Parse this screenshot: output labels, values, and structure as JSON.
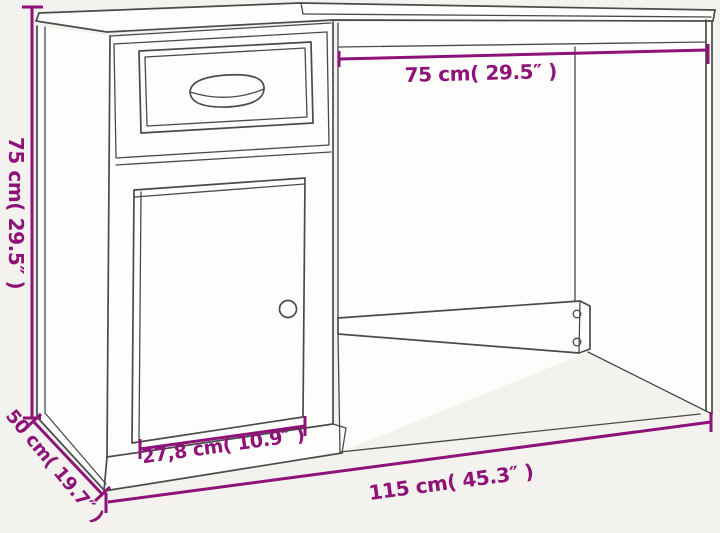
{
  "page": {
    "background_color": "#f3f2ef"
  },
  "drawing": {
    "subject": "desk with drawer and cabinet, technical line drawing",
    "line_color": "#4a4a4a",
    "face_color": "#fdfdfc",
    "parts": [
      "desktop",
      "left-side-panel",
      "drawer",
      "drawer-handle",
      "cabinet-door",
      "door-knob",
      "plinth",
      "back-rail",
      "screw-holes",
      "right-side-panel"
    ]
  },
  "dimensions": {
    "accent_color": "#8e1277",
    "height": {
      "label": "75 cm( 29.5″ )",
      "orientation": "vertical-left"
    },
    "desktop_section_width": {
      "label": "75 cm( 29.5″ )",
      "orientation": "horizontal-top"
    },
    "depth": {
      "label": "50 cm( 19.7″ )",
      "orientation": "diagonal-bottom-left"
    },
    "drawer_width": {
      "label": "27,8 cm( 10.9″ )",
      "orientation": "bottom-of-cabinet"
    },
    "overall_width": {
      "label": "115 cm( 45.3″ )",
      "orientation": "diagonal-bottom"
    }
  }
}
